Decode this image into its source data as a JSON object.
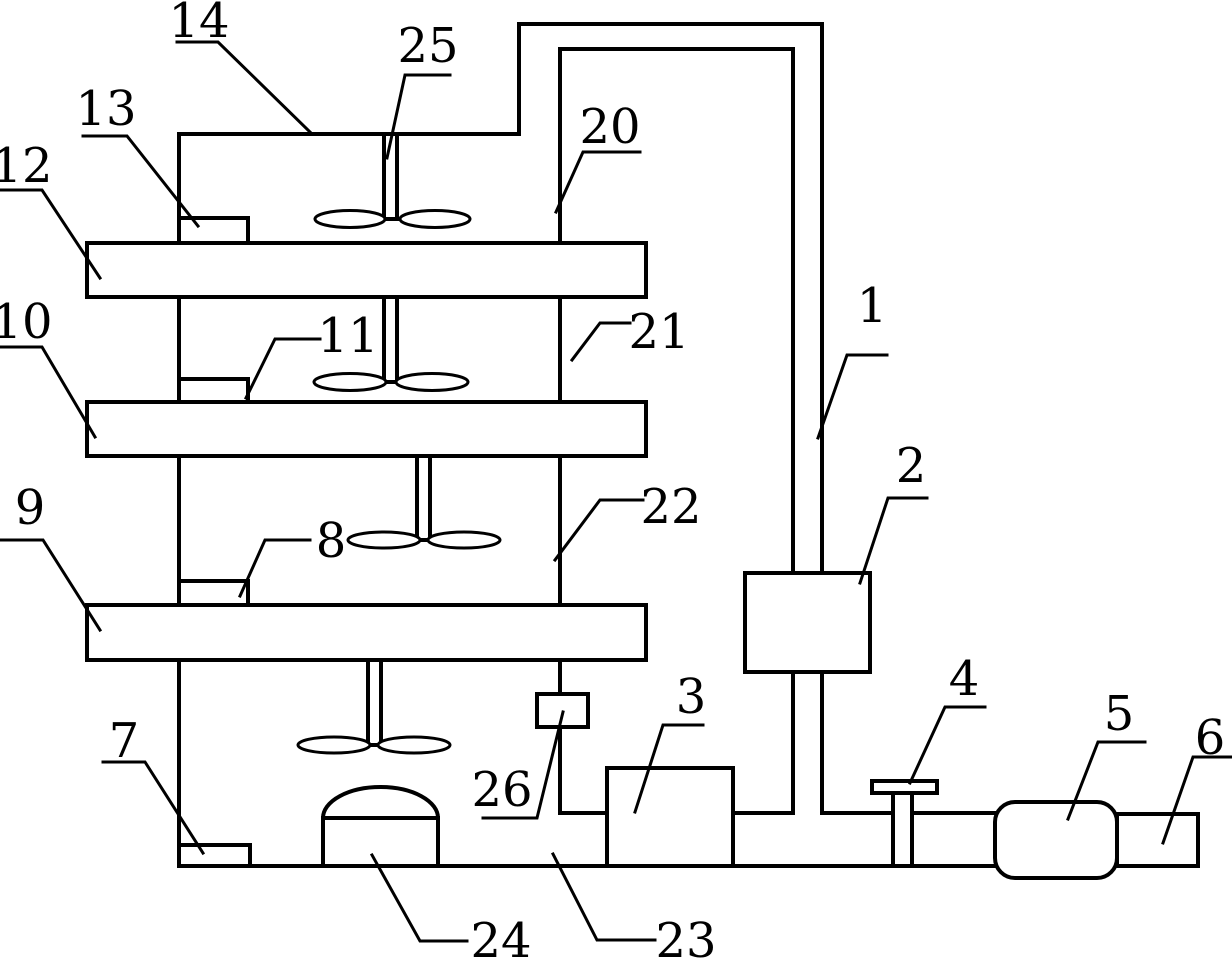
{
  "figure": {
    "type": "patent-line-drawing",
    "canvas": {
      "width": 1232,
      "height": 961,
      "background": "#ffffff",
      "line_color": "#000000"
    },
    "style": {
      "main_stroke": 4,
      "leader_stroke": 3,
      "label_font_size": 48
    },
    "shapes": [
      {
        "kind": "path",
        "name": "bottom-dome-24",
        "d": "M 323 866 L 323 818 A 57.5 31 0 0 1 438 818 L 438 866",
        "filled": true
      },
      {
        "kind": "polyline",
        "name": "riser-pipe-outer-line",
        "pts": [
          [
            519,
            134
          ],
          [
            519,
            24
          ],
          [
            822,
            24
          ],
          [
            822,
            573
          ]
        ]
      },
      {
        "kind": "polyline",
        "name": "riser-pipe-inner-line",
        "pts": [
          [
            560,
            49
          ],
          [
            793,
            49
          ],
          [
            793,
            573
          ]
        ]
      },
      {
        "kind": "line",
        "name": "tank-lid",
        "pts": [
          [
            179,
            134
          ],
          [
            519,
            134
          ]
        ]
      },
      {
        "kind": "line",
        "name": "tank-left-wall",
        "pts": [
          [
            179,
            134
          ],
          [
            179,
            866
          ]
        ]
      },
      {
        "kind": "line",
        "name": "tank-bottom",
        "pts": [
          [
            179,
            866
          ],
          [
            995,
            866
          ]
        ]
      },
      {
        "kind": "line",
        "name": "tank-right-wall-seg-1",
        "pts": [
          [
            560,
            49
          ],
          [
            560,
            243
          ]
        ]
      },
      {
        "kind": "line",
        "name": "tank-right-wall-seg-2",
        "pts": [
          [
            560,
            297
          ],
          [
            560,
            402
          ]
        ]
      },
      {
        "kind": "line",
        "name": "tank-right-wall-seg-3",
        "pts": [
          [
            560,
            456
          ],
          [
            560,
            605
          ]
        ]
      },
      {
        "kind": "line",
        "name": "tank-right-wall-seg-4",
        "pts": [
          [
            560,
            660
          ],
          [
            560,
            694
          ]
        ]
      },
      {
        "kind": "line",
        "name": "tank-right-wall-seg-5",
        "pts": [
          [
            560,
            727
          ],
          [
            560,
            813
          ]
        ]
      },
      {
        "kind": "line",
        "name": "downpipe-left-line",
        "pts": [
          [
            793,
            672
          ],
          [
            793,
            813
          ]
        ]
      },
      {
        "kind": "line",
        "name": "downpipe-right-line",
        "pts": [
          [
            822,
            672
          ],
          [
            822,
            813
          ]
        ]
      },
      {
        "kind": "line",
        "name": "bottom-pipe-top-seg-1",
        "pts": [
          [
            560,
            813
          ],
          [
            607,
            813
          ]
        ]
      },
      {
        "kind": "line",
        "name": "bottom-pipe-top-seg-2",
        "pts": [
          [
            733,
            813
          ],
          [
            793,
            813
          ]
        ]
      },
      {
        "kind": "line",
        "name": "bottom-pipe-top-seg-3",
        "pts": [
          [
            822,
            813
          ],
          [
            893,
            813
          ]
        ]
      },
      {
        "kind": "line",
        "name": "bottom-pipe-top-seg-4",
        "pts": [
          [
            912,
            813
          ],
          [
            995,
            813
          ]
        ]
      },
      {
        "kind": "line",
        "name": "dome-chord-line",
        "pts": [
          [
            323,
            818
          ],
          [
            438,
            818
          ]
        ]
      },
      {
        "kind": "rect",
        "name": "shelf-tray-upper-12",
        "x": 87,
        "y": 243,
        "w": 559,
        "h": 54
      },
      {
        "kind": "rect",
        "name": "shelf-tray-middle-10",
        "x": 87,
        "y": 402,
        "w": 559,
        "h": 54
      },
      {
        "kind": "rect",
        "name": "shelf-tray-lower-9",
        "x": 87,
        "y": 605,
        "w": 559,
        "h": 55
      },
      {
        "kind": "rect",
        "name": "wall-box-13",
        "x": 179,
        "y": 218,
        "w": 69,
        "h": 25
      },
      {
        "kind": "rect",
        "name": "wall-box-11",
        "x": 179,
        "y": 379,
        "w": 69,
        "h": 23
      },
      {
        "kind": "rect",
        "name": "wall-box-8",
        "x": 179,
        "y": 581,
        "w": 69,
        "h": 24
      },
      {
        "kind": "rect",
        "name": "wall-box-7",
        "x": 179,
        "y": 845,
        "w": 71,
        "h": 21
      },
      {
        "kind": "rect",
        "name": "wall-box-26",
        "x": 537,
        "y": 694,
        "w": 51,
        "h": 33
      },
      {
        "kind": "rect",
        "name": "stirrer-shaft-1",
        "x": 384,
        "y": 134,
        "w": 13,
        "h": 85
      },
      {
        "kind": "rect",
        "name": "stirrer-shaft-2",
        "x": 384,
        "y": 297,
        "w": 13,
        "h": 85
      },
      {
        "kind": "rect",
        "name": "stirrer-shaft-3",
        "x": 417,
        "y": 456,
        "w": 13,
        "h": 84
      },
      {
        "kind": "rect",
        "name": "stirrer-shaft-4",
        "x": 368,
        "y": 660,
        "w": 13,
        "h": 85
      },
      {
        "kind": "ellipse",
        "name": "stirrer-blade-1-left",
        "cx": 350,
        "cy": 219,
        "rx": 35,
        "ry": 8.5
      },
      {
        "kind": "ellipse",
        "name": "stirrer-blade-1-right",
        "cx": 435,
        "cy": 219,
        "rx": 35,
        "ry": 8.5
      },
      {
        "kind": "ellipse",
        "name": "stirrer-blade-2-left",
        "cx": 350,
        "cy": 382,
        "rx": 36,
        "ry": 8.5
      },
      {
        "kind": "ellipse",
        "name": "stirrer-blade-2-right",
        "cx": 432,
        "cy": 382,
        "rx": 36,
        "ry": 8.5
      },
      {
        "kind": "ellipse",
        "name": "stirrer-blade-3-left",
        "cx": 384,
        "cy": 540,
        "rx": 36,
        "ry": 8
      },
      {
        "kind": "ellipse",
        "name": "stirrer-blade-3-right",
        "cx": 464,
        "cy": 540,
        "rx": 36,
        "ry": 8
      },
      {
        "kind": "ellipse",
        "name": "stirrer-blade-4-left",
        "cx": 334,
        "cy": 745,
        "rx": 36,
        "ry": 8
      },
      {
        "kind": "ellipse",
        "name": "stirrer-blade-4-right",
        "cx": 414,
        "cy": 745,
        "rx": 36,
        "ry": 8
      },
      {
        "kind": "rect",
        "name": "device-box-2",
        "x": 745,
        "y": 573,
        "w": 125,
        "h": 99
      },
      {
        "kind": "rect",
        "name": "device-box-3",
        "x": 607,
        "y": 768,
        "w": 126,
        "h": 98
      },
      {
        "kind": "rect",
        "name": "valve-handle-4",
        "x": 872,
        "y": 781,
        "w": 65,
        "h": 12
      },
      {
        "kind": "line",
        "name": "valve-stem-left-line",
        "pts": [
          [
            893,
            793
          ],
          [
            893,
            866
          ]
        ]
      },
      {
        "kind": "line",
        "name": "valve-stem-right-line",
        "pts": [
          [
            912,
            793
          ],
          [
            912,
            866
          ]
        ]
      },
      {
        "kind": "rect",
        "name": "outlet-stub-6",
        "x": 1117,
        "y": 814,
        "w": 81,
        "h": 52
      },
      {
        "kind": "roundrect",
        "name": "pump-body-5",
        "x": 995,
        "y": 802,
        "w": 122,
        "h": 76,
        "r": 20
      }
    ],
    "labels": [
      {
        "text": "1",
        "x": 872,
        "y": 306,
        "leader": [
          [
            887,
            355
          ],
          [
            847,
            355
          ],
          [
            818,
            438
          ]
        ]
      },
      {
        "text": "2",
        "x": 911,
        "y": 466,
        "leader": [
          [
            927,
            498
          ],
          [
            888,
            498
          ],
          [
            860,
            583
          ]
        ]
      },
      {
        "text": "3",
        "x": 691,
        "y": 697,
        "leader": [
          [
            703,
            725
          ],
          [
            663,
            725
          ],
          [
            635,
            812
          ]
        ]
      },
      {
        "text": "4",
        "x": 964,
        "y": 679,
        "leader": [
          [
            985,
            707
          ],
          [
            945,
            707
          ],
          [
            910,
            783
          ]
        ]
      },
      {
        "text": "5",
        "x": 1119,
        "y": 714,
        "leader": [
          [
            1145,
            742
          ],
          [
            1098,
            742
          ],
          [
            1068,
            819
          ]
        ]
      },
      {
        "text": "6",
        "x": 1210,
        "y": 738,
        "leader": [
          [
            1232,
            757
          ],
          [
            1193,
            757
          ],
          [
            1163,
            843
          ]
        ]
      },
      {
        "text": "7",
        "x": 124,
        "y": 741,
        "leader": [
          [
            103,
            762
          ],
          [
            145,
            762
          ],
          [
            203,
            853
          ]
        ]
      },
      {
        "text": "8",
        "x": 331,
        "y": 541,
        "leader": [
          [
            310,
            540
          ],
          [
            265,
            540
          ],
          [
            240,
            596
          ]
        ]
      },
      {
        "text": "9",
        "x": 30,
        "y": 508,
        "leader": [
          [
            0,
            540
          ],
          [
            43,
            540
          ],
          [
            100,
            630
          ]
        ]
      },
      {
        "text": "10",
        "x": 22,
        "y": 322,
        "leader": [
          [
            0,
            347
          ],
          [
            42,
            347
          ],
          [
            95,
            437
          ]
        ]
      },
      {
        "text": "11",
        "x": 348,
        "y": 336,
        "leader": [
          [
            320,
            339
          ],
          [
            275,
            339
          ],
          [
            246,
            398
          ]
        ]
      },
      {
        "text": "12",
        "x": 22,
        "y": 166,
        "leader": [
          [
            0,
            190
          ],
          [
            42,
            190
          ],
          [
            100,
            278
          ]
        ]
      },
      {
        "text": "13",
        "x": 106,
        "y": 109,
        "leader": [
          [
            83,
            136
          ],
          [
            127,
            136
          ],
          [
            198,
            226
          ]
        ]
      },
      {
        "text": "14",
        "x": 199,
        "y": 21,
        "leader": [
          [
            177,
            42
          ],
          [
            218,
            42
          ],
          [
            310,
            132
          ]
        ]
      },
      {
        "text": "20",
        "x": 610,
        "y": 127,
        "leader": [
          [
            640,
            152
          ],
          [
            583,
            152
          ],
          [
            556,
            212
          ]
        ]
      },
      {
        "text": "21",
        "x": 659,
        "y": 332,
        "leader": [
          [
            630,
            323
          ],
          [
            600,
            323
          ],
          [
            572,
            360
          ]
        ]
      },
      {
        "text": "22",
        "x": 671,
        "y": 507,
        "leader": [
          [
            643,
            500
          ],
          [
            600,
            500
          ],
          [
            555,
            560
          ]
        ]
      },
      {
        "text": "23",
        "x": 686,
        "y": 941,
        "leader": [
          [
            655,
            940
          ],
          [
            597,
            940
          ],
          [
            553,
            854
          ]
        ]
      },
      {
        "text": "24",
        "x": 501,
        "y": 941,
        "leader": [
          [
            467,
            941
          ],
          [
            420,
            941
          ],
          [
            372,
            855
          ]
        ]
      },
      {
        "text": "25",
        "x": 428,
        "y": 46,
        "leader": [
          [
            450,
            75
          ],
          [
            405,
            75
          ],
          [
            387,
            158
          ]
        ]
      },
      {
        "text": "26",
        "x": 502,
        "y": 790,
        "leader": [
          [
            483,
            818
          ],
          [
            537,
            818
          ],
          [
            563,
            712
          ]
        ]
      }
    ]
  }
}
